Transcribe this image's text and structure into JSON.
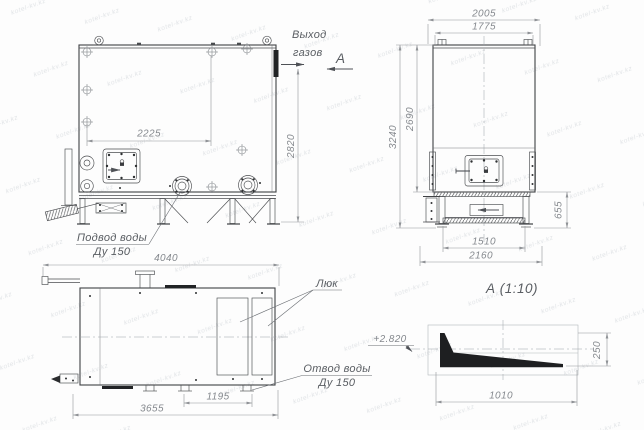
{
  "watermark": {
    "text": "kotel-kv.kz"
  },
  "front_view": {
    "gas_outlet_line1": "Выход",
    "gas_outlet_line2": "газов",
    "view_label": "А",
    "dim_door_span": "2225",
    "dim_outlet_height": "2820",
    "water_inlet_line1": "Подвод воды",
    "water_inlet_line2": "Ду 150"
  },
  "side_view": {
    "dim_width_overall": "2005",
    "dim_width_top": "1775",
    "dim_height_overall": "3240",
    "dim_height_body": "2690",
    "dim_base_height": "655",
    "dim_base_width_inner": "1510",
    "dim_base_width_overall": "2160"
  },
  "plan_view": {
    "dim_length_overall": "4040",
    "dim_length_body": "3655",
    "dim_outlet_offset": "1195",
    "hatch_label": "Люк",
    "water_outlet_line1": "Отвод воды",
    "water_outlet_line2": "Ду 150"
  },
  "detail_view": {
    "title": "А (1:10)",
    "level_mark": "+2.820",
    "dim_height": "250",
    "dim_length": "1010"
  }
}
